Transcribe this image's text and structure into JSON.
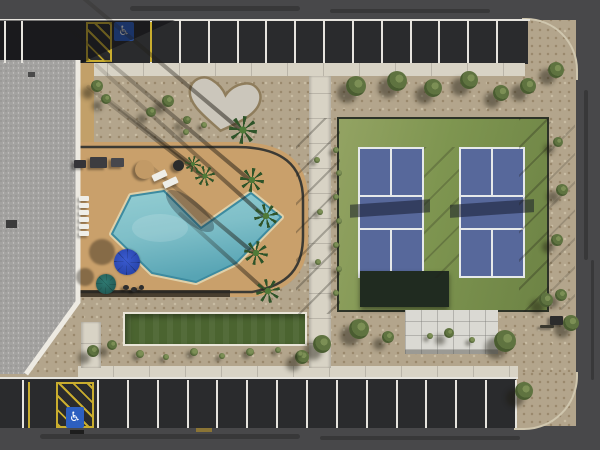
{
  "meta": {
    "title": "Aerial view of community recreation area",
    "description": "Top-down drone photograph of a clubhouse roof, free-form swimming pool with tan deck, palm trees and umbrellas, a bocce ball court, two fenced pickleball courts, a concrete pad, desert gravel landscaping with a heart-shaped rock garden, and parking lots with accessible stalls."
  },
  "icons": {
    "accessible_glyph": "♿"
  },
  "labels": {
    "building": "clubhouse-roof",
    "pool": "swimming-pool",
    "deck": "pool-deck",
    "bocce": "bocce-court",
    "court_left": "pickleball-court-left",
    "court_right": "pickleball-court-right",
    "pad": "concrete-pad",
    "heart": "heart-shaped-rock-garden",
    "parking_top": "top-parking-row",
    "parking_bottom": "bottom-parking-row"
  },
  "colors": {
    "gravel": "#b3a58c",
    "gravel-dot1": "#99886c",
    "gravel-dot2": "#c9bda4",
    "road": "#48484a",
    "asphalt": "#2a2b2d",
    "line-white": "#e6e4de",
    "line-yellow": "#c9ad2e",
    "curb": "#cfc6ae",
    "sidewalk": "#d8d3c5",
    "roof": "#a3a2a0",
    "roof-trim": "#edeae2",
    "wall-tan": "#c2a069",
    "deck": "#c9a06b",
    "fence": "#3b3a34",
    "pool-light": "#93cdd2",
    "pool-mid": "#7fbfc8",
    "pool-deep": "#57a4b4",
    "pool-edge": "#3d8ba0",
    "coping": "#dfd0a9",
    "turf": "#4b6430",
    "turf-frame": "#e9e5d8",
    "court-green": "#7e9550",
    "court-green-light": "#93a363",
    "court-blue": "#57689b",
    "court-line": "#e6e9ea",
    "windscreen": "#202b20",
    "pad": "#dad9d3",
    "heart-rock": "#cbc6bb",
    "heart-edge": "#8f7d5c",
    "tree-dark": "#4a5c31",
    "tree-mid": "#5f7340",
    "tree-light": "#7c8f55",
    "palm": "#2f5429",
    "palm-light": "#4f7a38",
    "sign-blue": "#2d5fc0",
    "umbrella-blue": "#3a5bd0",
    "umbrella-teal": "#2f7a72"
  },
  "parking": {
    "top_row": {
      "stall_count": 12,
      "accessible_stalls": 1,
      "no_park_hatch": true
    },
    "bottom_row": {
      "stall_count": 14,
      "accessible_stalls": 1,
      "no_park_hatch": true
    }
  },
  "scene": {
    "stall_lines_top": {
      "x0": 150,
      "x1": 496,
      "n": 13,
      "y": 21,
      "h": 42
    },
    "stall_lines_bottom": {
      "x0": 97,
      "x1": 515,
      "n": 15,
      "y": 380,
      "h": 48
    },
    "extra_white_lines": [
      [
        4,
        21,
        42
      ],
      [
        21,
        21,
        42
      ],
      [
        22,
        380,
        48
      ]
    ],
    "yellow_lines": [
      [
        150,
        22,
        40
      ],
      [
        28,
        382,
        46
      ]
    ],
    "trees": [
      [
        356,
        86,
        10
      ],
      [
        397,
        81,
        10
      ],
      [
        433,
        88,
        9
      ],
      [
        469,
        80,
        9
      ],
      [
        501,
        93,
        8
      ],
      [
        528,
        86,
        8
      ],
      [
        556,
        70,
        8
      ],
      [
        558,
        142,
        5
      ],
      [
        562,
        190,
        6
      ],
      [
        557,
        240,
        6
      ],
      [
        561,
        295,
        6
      ],
      [
        322,
        344,
        9
      ],
      [
        359,
        329,
        10
      ],
      [
        302,
        357,
        7
      ],
      [
        388,
        337,
        6
      ],
      [
        449,
        333,
        5
      ],
      [
        505,
        341,
        11
      ],
      [
        546,
        300,
        7
      ],
      [
        571,
        323,
        8
      ],
      [
        524,
        391,
        9
      ],
      [
        93,
        351,
        6
      ],
      [
        112,
        345,
        5
      ],
      [
        97,
        86,
        6
      ],
      [
        106,
        99,
        5
      ],
      [
        168,
        101,
        6
      ],
      [
        151,
        112,
        5
      ],
      [
        187,
        120,
        4
      ]
    ],
    "shrubs": [
      [
        140,
        354,
        4
      ],
      [
        166,
        357,
        3
      ],
      [
        194,
        352,
        4
      ],
      [
        222,
        356,
        3
      ],
      [
        250,
        352,
        4
      ],
      [
        278,
        350,
        3
      ],
      [
        300,
        354,
        3
      ],
      [
        336,
        150,
        3
      ],
      [
        339,
        173,
        3
      ],
      [
        336,
        197,
        3
      ],
      [
        339,
        221,
        3
      ],
      [
        336,
        245,
        3
      ],
      [
        339,
        269,
        3
      ],
      [
        336,
        293,
        3
      ],
      [
        317,
        160,
        3
      ],
      [
        320,
        212,
        3
      ],
      [
        318,
        262,
        3
      ],
      [
        472,
        340,
        3
      ],
      [
        430,
        336,
        3
      ],
      [
        204,
        125,
        3
      ],
      [
        186,
        132,
        3
      ]
    ],
    "palms": [
      [
        243,
        130,
        14
      ],
      [
        205,
        176,
        10
      ],
      [
        252,
        180,
        12
      ],
      [
        266,
        216,
        12
      ],
      [
        256,
        253,
        12
      ],
      [
        268,
        291,
        12
      ],
      [
        193,
        164,
        8
      ]
    ],
    "palm_shadows": [
      [
        243,
        130,
        235,
        -140
      ],
      [
        252,
        180,
        240,
        -140
      ],
      [
        266,
        216,
        230,
        -138
      ],
      [
        256,
        253,
        140,
        -140
      ],
      [
        268,
        291,
        120,
        -138
      ],
      [
        205,
        176,
        150,
        -142
      ],
      [
        193,
        164,
        110,
        -142
      ]
    ],
    "umbrellas": [
      [
        127,
        262,
        13,
        "#3a5bd0",
        "#203c9e"
      ],
      [
        106,
        284,
        10,
        "#2f7a72",
        "#1d4f4b"
      ]
    ],
    "umbrella_shadows": [
      [
        102,
        252,
        13
      ],
      [
        85,
        277,
        9
      ]
    ],
    "loungers": [
      [
        152,
        172,
        15,
        7,
        -25
      ],
      [
        163,
        179,
        15,
        7,
        -25
      ],
      [
        79,
        196,
        10,
        5,
        0
      ],
      [
        79,
        203,
        10,
        5,
        0
      ],
      [
        79,
        210,
        10,
        5,
        0
      ],
      [
        79,
        217,
        10,
        5,
        0
      ],
      [
        79,
        224,
        10,
        5,
        0
      ],
      [
        79,
        231,
        10,
        5,
        0
      ]
    ],
    "furniture": [
      [
        90,
        157,
        17,
        11,
        "#3c3c40",
        0
      ],
      [
        111,
        158,
        13,
        9,
        "#47474c",
        0
      ],
      [
        74,
        160,
        12,
        8,
        "#343438",
        0
      ],
      [
        173,
        160,
        11,
        11,
        "#2b2b2b",
        1
      ],
      [
        135,
        160,
        19,
        19,
        "#c29a66",
        1
      ],
      [
        123,
        285,
        6,
        5,
        "#2e2e2e",
        1
      ],
      [
        131,
        287,
        6,
        5,
        "#2e2e2e",
        1
      ],
      [
        139,
        285,
        5,
        5,
        "#2e2e2e",
        1
      ],
      [
        550,
        316,
        13,
        9,
        "#2c2c2c",
        0
      ],
      [
        540,
        325,
        14,
        3,
        "#3a382e",
        0
      ]
    ],
    "wheel_stops": [
      [
        70,
        430,
        14,
        4,
        "#1d1d1d"
      ],
      [
        196,
        428,
        16,
        4,
        "#8a7435"
      ]
    ],
    "tire_marks": [
      [
        130,
        6,
        170,
        5
      ],
      [
        330,
        9,
        160,
        4
      ],
      [
        40,
        434,
        260,
        5
      ],
      [
        320,
        436,
        200,
        4
      ],
      [
        584,
        90,
        4,
        170
      ],
      [
        591,
        260,
        3,
        120
      ]
    ]
  }
}
